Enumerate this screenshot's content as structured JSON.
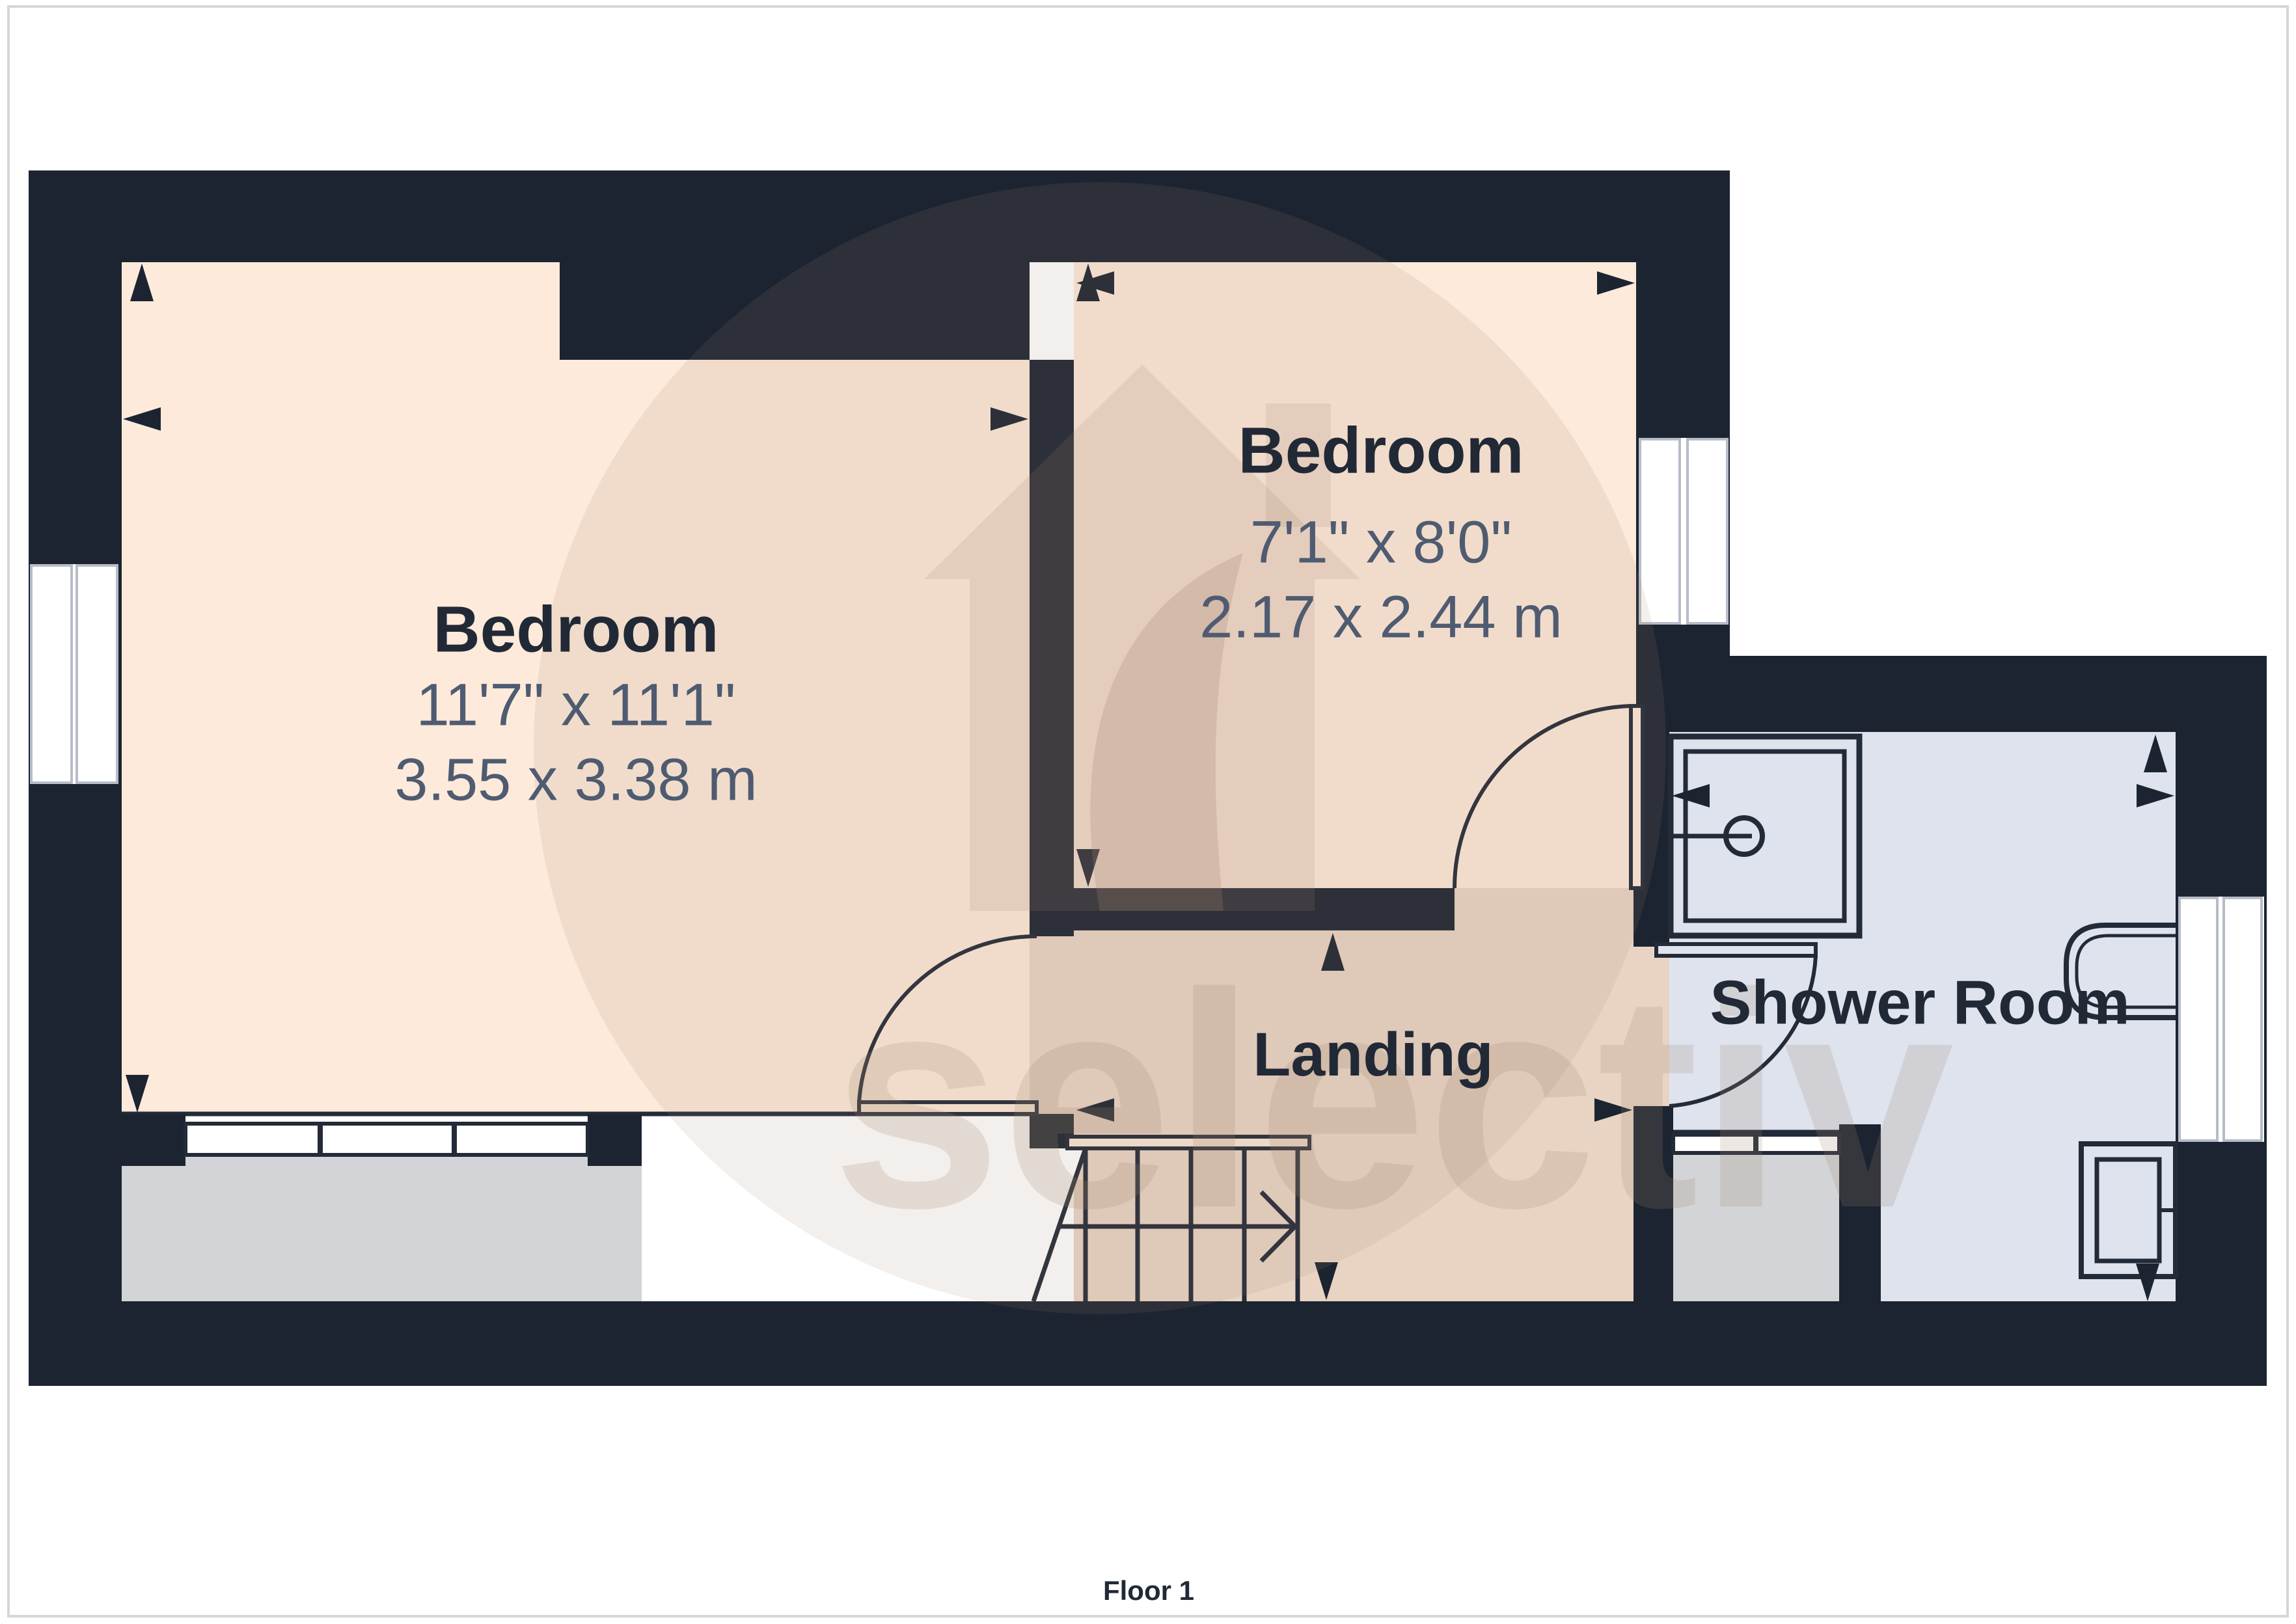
{
  "page": {
    "floor_label": "Floor 1",
    "background": "#ffffff",
    "border_color": "#d6d6d6"
  },
  "palette": {
    "wall": "#1c2431",
    "bedroom_floor": "#fdeadb",
    "landing_floor": "#e9d4c4",
    "shower_floor": "#dee3ee",
    "bay_floor": "#d3d4d7",
    "window_white": "#ffffff",
    "line": "#232a38",
    "title_text": "#222936",
    "dim_text": "#4f5b70",
    "watermark_color": "#a08570"
  },
  "rooms": [
    {
      "id": "bedroom-left",
      "name": "Bedroom",
      "dimensions_imperial": "11'7\" x 11'1\"",
      "dimensions_metric": "3.55 x 3.38 m"
    },
    {
      "id": "bedroom-right",
      "name": "Bedroom",
      "dimensions_imperial": "7'1\" x 8'0\"",
      "dimensions_metric": "2.17 x 2.44 m"
    },
    {
      "id": "landing",
      "name": "Landing"
    },
    {
      "id": "shower-room",
      "name": "Shower Room"
    }
  ],
  "watermark": {
    "text": "selectiv"
  }
}
